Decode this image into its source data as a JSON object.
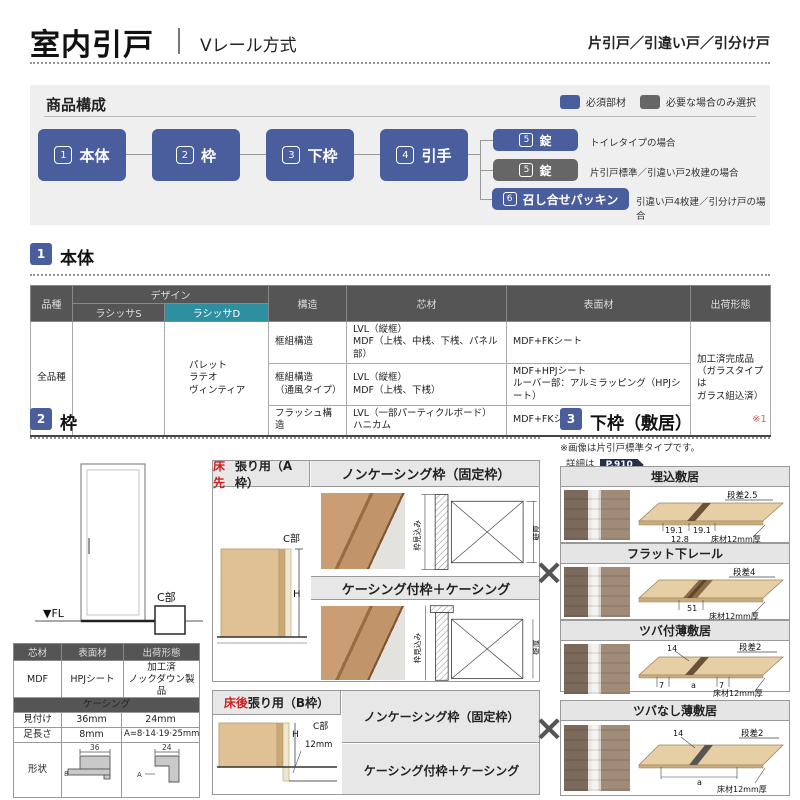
{
  "colors": {
    "accent_blue": "#4a5d9d",
    "optional_gray": "#666666",
    "teal_header": "#2e8fa0",
    "red_note": "#c22222"
  },
  "header": {
    "title": "室内引戸",
    "subtitle": "Vレール方式",
    "door_types": "片引戸／引違い戸／引分け戸"
  },
  "composition": {
    "title": "商品構成",
    "legend": [
      {
        "label": "必須部材"
      },
      {
        "label": "必要な場合のみ選択"
      }
    ],
    "flow": [
      {
        "num": "1",
        "label": "本体"
      },
      {
        "num": "2",
        "label": "枠"
      },
      {
        "num": "3",
        "label": "下枠"
      },
      {
        "num": "4",
        "label": "引手"
      }
    ],
    "branches": [
      {
        "num": "5",
        "label": "錠",
        "note": "トイレタイプの場合"
      },
      {
        "num": "5",
        "label": "錠",
        "note": "片引戸標準／引違い戸2枚建の場合"
      },
      {
        "num": "6",
        "label": "召し合せパッキン",
        "note": "引違い戸4枚建／引分け戸の場合"
      }
    ]
  },
  "body_section": {
    "num": "1",
    "title": "本体",
    "table": {
      "col_hinshu": "品種",
      "col_design": "デザイン",
      "col_s": "ラシッサS",
      "col_d": "ラシッサD",
      "col_kozo": "構造",
      "col_core": "芯材",
      "col_surface": "表面材",
      "col_ship": "出荷形態",
      "hinshu": "全品種",
      "design_d": "パレット\nラテオ\nヴィンティア",
      "rows": [
        {
          "kozo": "框組構造",
          "core": "LVL（縦框）\nMDF（上桟、中桟、下桟、パネル部）",
          "surface": "MDF+FKシート"
        },
        {
          "kozo": "框組構造\n（通風タイプ）",
          "core": "LVL（縦框）\nMDF（上桟、下桟）",
          "surface": "MDF+HPJシート\nルーバー部：アルミラッピング（HPJシート）"
        },
        {
          "kozo": "フラッシュ構造",
          "core": "LVL（一部パーティクルボード）\nハニカム",
          "surface": "MDF+FKシート"
        }
      ],
      "ship": "加工済完成品\n（ガラスタイプは\nガラス組込済）"
    }
  },
  "frame_section": {
    "num": "2",
    "title": "枠",
    "elevation": {
      "fl": "▼FL",
      "c": "C部"
    },
    "spec": {
      "headers": [
        "芯材",
        "表面材",
        "出荷形態"
      ],
      "values": [
        "MDF",
        "HPJシート",
        "加工済\nノックダウン製品"
      ]
    },
    "casing": {
      "title": "ケーシング",
      "row1": [
        "見付け",
        "36mm",
        "24mm"
      ],
      "row2": [
        "足長さ",
        "8mm",
        "A=8·14·19·25mm"
      ],
      "shape_label": "形状",
      "dim_36": "36",
      "dim_8": "8",
      "dim_24": "24",
      "dim_a": "A"
    },
    "frame_a": {
      "red": "床先",
      "rest": "張り用（A枠）",
      "c": "C部",
      "h": "H",
      "noncasing": "ノンケーシング枠（固定枠）",
      "casing": "ケーシング付枠＋ケーシング",
      "dim_depth": "枠見込み",
      "dim_wall": "壁厚"
    },
    "frame_b": {
      "red": "床後",
      "rest": "張り用（B枠）",
      "h": "H",
      "c": "C部",
      "mm12": "12mm",
      "noncasing": "ノンケーシング枠（固定枠）",
      "casing": "ケーシング付枠＋ケーシング"
    }
  },
  "sill_section": {
    "num": "3",
    "title": "下枠（敷居）",
    "ref": "※1",
    "note": "※画像は片引戸標準タイプです。",
    "detail_label": "詳細は",
    "page": "P.910",
    "panels": [
      {
        "title": "埋込敷居",
        "step": "段差2.5",
        "d1": "19.1",
        "d2": "19.1",
        "d3": "12.8",
        "floor": "床材12mm厚"
      },
      {
        "title": "フラット下レール",
        "step": "段差4",
        "d1": "51",
        "floor": "床材12mm厚"
      },
      {
        "title": "ツバ付薄敷居",
        "step": "段差2",
        "d0": "14",
        "d1": "7",
        "d2": "a",
        "d3": "7",
        "floor": "床材12mm厚"
      },
      {
        "title": "ツバなし薄敷居",
        "step": "段差2",
        "d0": "14",
        "d2": "a",
        "floor": "床材12mm厚"
      }
    ]
  }
}
